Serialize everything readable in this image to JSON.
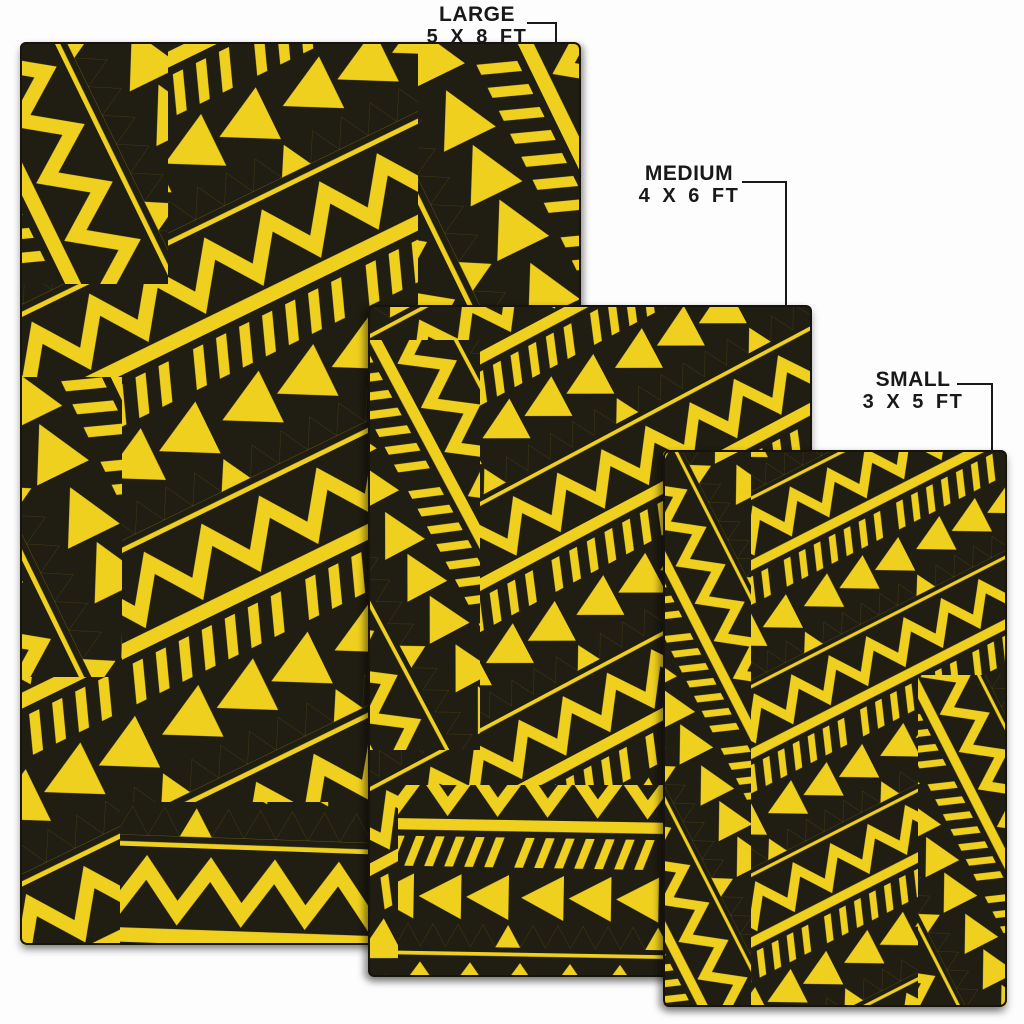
{
  "sizes": [
    {
      "name": "LARGE",
      "dimensions": "5 X 8 FT"
    },
    {
      "name": "MEDIUM",
      "dimensions": "4 X 6 FT"
    },
    {
      "name": "SMALL",
      "dimensions": "3 X 5 FT"
    }
  ],
  "colors": {
    "pattern_yellow": "#efd01f",
    "pattern_black": "#201d12",
    "background": "#fdfdfd",
    "label_text": "#191919",
    "leader_line": "#191919",
    "rug_border": "#17140d"
  }
}
